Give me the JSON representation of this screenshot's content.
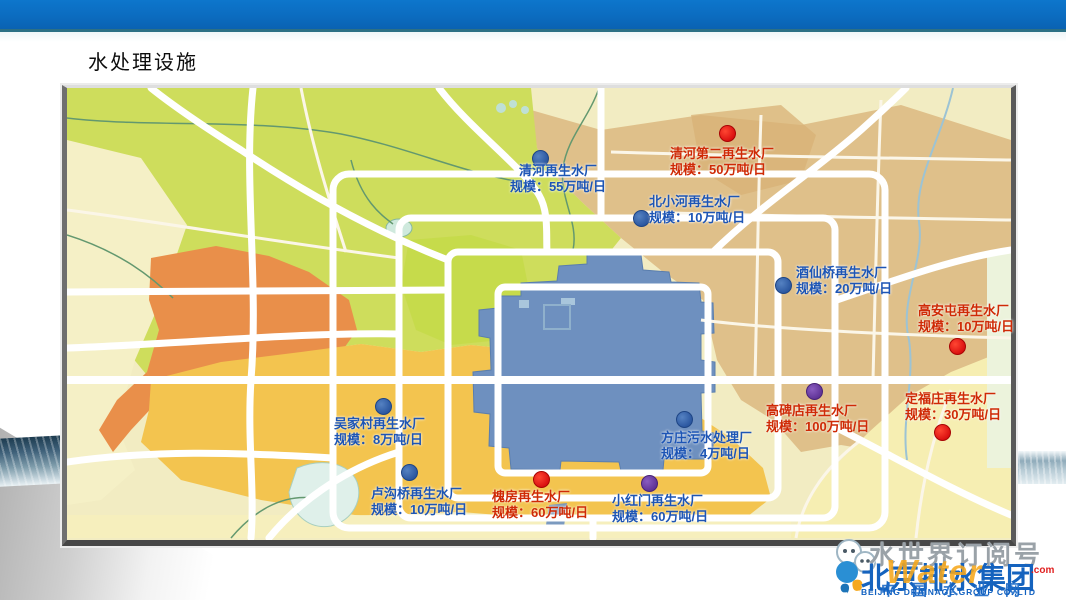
{
  "slide": {
    "title": "水处理设施"
  },
  "palette": {
    "topbar": "#0b6cc0",
    "topbar_edge": "#2c7085",
    "label_blue": "#1d55b5",
    "label_red": "#cf2a06",
    "dot_blue": "#2b57a0",
    "dot_red": "#da1010",
    "dot_purple": "#5f3396",
    "map_green": "#cedd5c",
    "map_tan": "#dfc08a",
    "map_orange": "#e98f4a",
    "map_gold": "#f3c44f",
    "map_city_blue": "#6e90bf",
    "map_cream": "#f2ecc2"
  },
  "map": {
    "facilities": [
      {
        "id": "qinghe",
        "name": "清河再生水厂",
        "scale": "规模：55万吨/日",
        "color": "blue",
        "dot": "blue",
        "dx": 540,
        "dy": 158,
        "lx": 499,
        "ly": 163,
        "w": 118,
        "align": "center"
      },
      {
        "id": "qinghe2",
        "name": "清河第二再生水厂",
        "scale": "规模：50万吨/日",
        "color": "red",
        "dot": "red",
        "dx": 727,
        "dy": 133,
        "lx": 670,
        "ly": 146,
        "w": 118,
        "align": "left"
      },
      {
        "id": "beixiaohe",
        "name": "北小河再生水厂",
        "scale": "规模：10万吨/日",
        "color": "blue",
        "dot": "blue",
        "dx": 641,
        "dy": 218,
        "lx": 649,
        "ly": 194,
        "w": 110,
        "align": "left"
      },
      {
        "id": "jiuxianqiao",
        "name": "酒仙桥再生水厂",
        "scale": "规模：20万吨/日",
        "color": "blue",
        "dot": "blue",
        "dx": 783,
        "dy": 285,
        "lx": 796,
        "ly": 265,
        "w": 110,
        "align": "left"
      },
      {
        "id": "gaoantun",
        "name": "高安屯再生水厂",
        "scale": "规模：10万吨/日",
        "color": "red",
        "dot": "red",
        "dx": 957,
        "dy": 346,
        "lx": 918,
        "ly": 303,
        "w": 108,
        "align": "left"
      },
      {
        "id": "gaobeidian",
        "name": "高碑店再生水厂",
        "scale": "规模：100万吨/日",
        "color": "red",
        "dot": "purple",
        "dx": 814,
        "dy": 391,
        "lx": 766,
        "ly": 403,
        "w": 118,
        "align": "left"
      },
      {
        "id": "dingfuzhuang",
        "name": "定福庄再生水厂",
        "scale": "规模：30万吨/日",
        "color": "red",
        "dot": "red",
        "dx": 942,
        "dy": 432,
        "lx": 905,
        "ly": 391,
        "w": 108,
        "align": "left"
      },
      {
        "id": "wujiacun",
        "name": "吴家村再生水厂",
        "scale": "规模：8万吨/日",
        "color": "blue",
        "dot": "blue",
        "dx": 383,
        "dy": 406,
        "lx": 334,
        "ly": 416,
        "w": 105,
        "align": "left"
      },
      {
        "id": "lugouqiao",
        "name": "卢沟桥再生水厂",
        "scale": "规模：10万吨/日",
        "color": "blue",
        "dot": "blue",
        "dx": 409,
        "dy": 472,
        "lx": 371,
        "ly": 486,
        "w": 108,
        "align": "left"
      },
      {
        "id": "huaifang",
        "name": "槐房再生水厂",
        "scale": "规模：60万吨/日",
        "color": "red",
        "dot": "red",
        "dx": 541,
        "dy": 479,
        "lx": 492,
        "ly": 489,
        "w": 108,
        "align": "left"
      },
      {
        "id": "xiaohongmen",
        "name": "小红门再生水厂",
        "scale": "规模：60万吨/日",
        "color": "blue",
        "dot": "purple",
        "dx": 649,
        "dy": 483,
        "lx": 612,
        "ly": 493,
        "w": 110,
        "align": "left"
      },
      {
        "id": "fangzhuang",
        "name": "方庄污水处理厂",
        "scale": "规模：4万吨/日",
        "color": "blue",
        "dot": "blue",
        "dx": 684,
        "dy": 419,
        "lx": 661,
        "ly": 430,
        "w": 105,
        "align": "left"
      }
    ]
  },
  "watermark": {
    "subscription": "水世界订阅号",
    "company": "北京排水集团",
    "company_en": "BEIJING DRAINAGE GROUP CO.,LTD",
    "water_word": "Water",
    "water_suffix": ".com",
    "cn_site": "中国水业网"
  }
}
